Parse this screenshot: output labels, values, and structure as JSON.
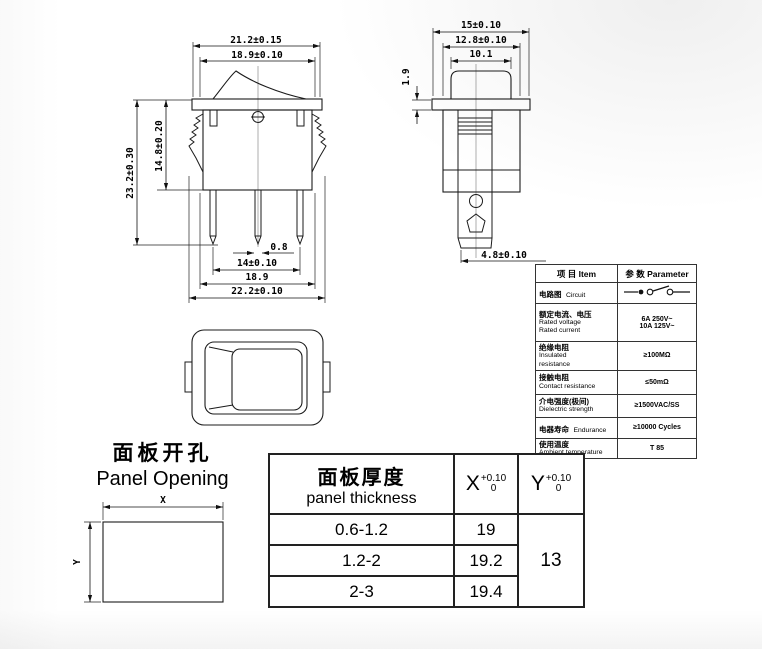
{
  "front_view": {
    "dims": {
      "width_flange": "21.2±0.15",
      "width_inner_top": "18.9±0.10",
      "height_total": "23.2±0.30",
      "height_body": "14.8±0.20",
      "terminal_thickness": "0.8",
      "terminal_pitch": "14±0.10",
      "width_inner_bottom": "18.9",
      "width_total": "22.2±0.10"
    }
  },
  "side_view": {
    "dims": {
      "width_flange": "15±0.10",
      "width_body": "12.8±0.10",
      "width_rocker": "10.1",
      "flange_thickness": "1.9",
      "terminal_length": "4.8±0.10"
    }
  },
  "panel_opening": {
    "title_cn": "面板开孔",
    "title_en": "Panel Opening",
    "dim_x": "X",
    "dim_y": "Y"
  },
  "spec_table": {
    "header": {
      "item": "项 目  Item",
      "parameter": "参 数  Parameter"
    },
    "circuit": {
      "cn": "电路图",
      "en": "Circuit"
    },
    "rated": {
      "cn": "额定电流、电压",
      "en1": "Rated voltage",
      "en2": "Rated current",
      "v1": "6A 250V~",
      "v2": "10A 125V~"
    },
    "insulated": {
      "cn": "绝缘电阻",
      "en1": "Insulated",
      "en2": "resistance",
      "v": "≥100MΩ"
    },
    "contact": {
      "cn": "接触电阻",
      "en": "Contact resistance",
      "v": "≤50mΩ"
    },
    "dielectric": {
      "cn": "介电强度(极间)",
      "en": "Dielectric strength",
      "v": "≥1500VAC/SS"
    },
    "endurance": {
      "cn": "电器寿命",
      "en": "Endurance",
      "v": "≥10000 Cycles"
    },
    "ambient": {
      "cn": "使用温度",
      "en": "Ambient temperature",
      "v": "T 85"
    }
  },
  "thickness_table": {
    "header_cn": "面板厚度",
    "header_en": "panel thickness",
    "x_base": "X",
    "x_tol_top": "+0.10",
    "x_tol_bottom": "0",
    "y_base": "Y",
    "y_tol_top": "+0.10",
    "y_tol_bottom": "0",
    "rows": [
      {
        "thickness": "0.6-1.2",
        "x": "19"
      },
      {
        "thickness": "1.2-2",
        "x": "19.2"
      },
      {
        "thickness": "2-3",
        "x": "19.4"
      }
    ],
    "y_value": "13"
  },
  "colors": {
    "line": "#1b1b1b",
    "background": "#ffffff"
  }
}
